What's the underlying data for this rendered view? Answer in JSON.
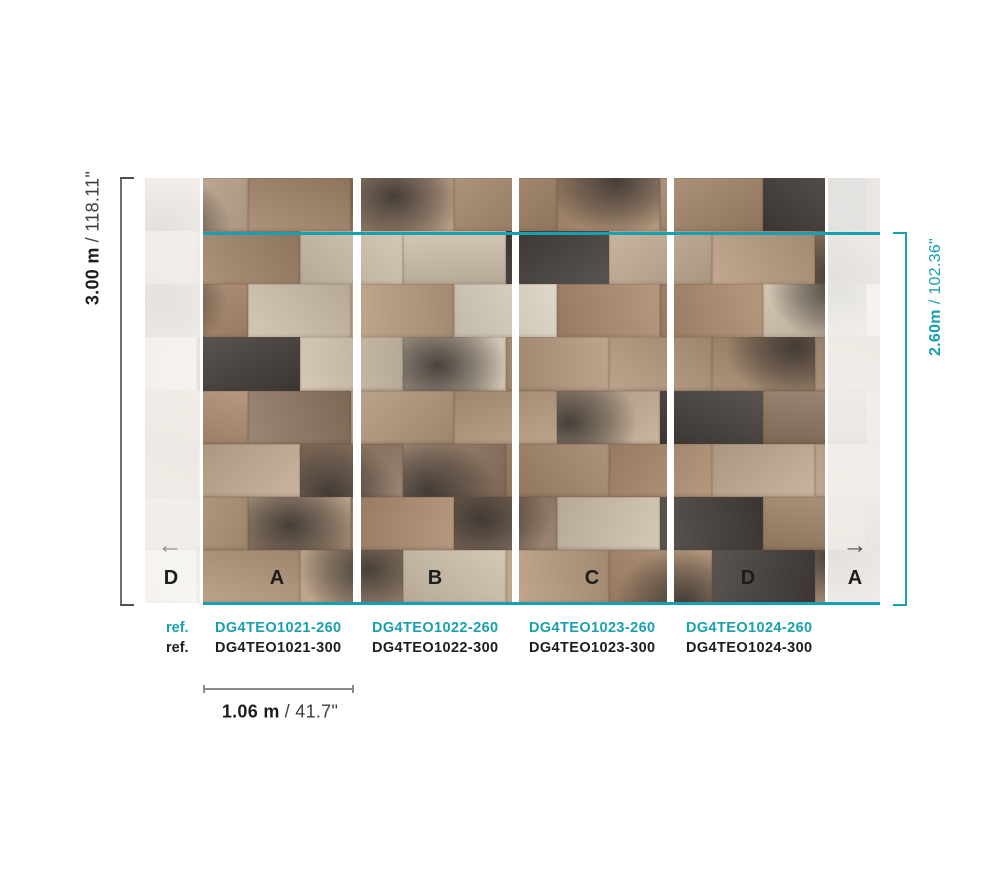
{
  "colors": {
    "teal": "#18a0b0",
    "text_black": "#1d1d1b",
    "bracket_gray": "#6f6f6f",
    "dim_secondary": "#3c3c3c"
  },
  "dimensions": {
    "full_height": {
      "metric": "3.00 m",
      "imperial": "/ 118.11\""
    },
    "panel_drop_height": {
      "metric": "2.60m",
      "imperial": "/ 102.36\""
    },
    "panel_width": {
      "metric": "1.06 m",
      "imperial": "/ 41.7\""
    }
  },
  "panels": [
    {
      "label": "D"
    },
    {
      "label": "A"
    },
    {
      "label": "B"
    },
    {
      "label": "C"
    },
    {
      "label": "D"
    },
    {
      "label": "A"
    }
  ],
  "icons": {
    "arrow_left": "←",
    "arrow_right": "→"
  },
  "references": {
    "rows": [
      {
        "label": "ref.",
        "codes": [
          "DG4TEO1021-260",
          "DG4TEO1022-260",
          "DG4TEO1023-260",
          "DG4TEO1024-260"
        ]
      },
      {
        "label": "ref.",
        "codes": [
          "DG4TEO1021-300",
          "DG4TEO1022-300",
          "DG4TEO1023-300",
          "DG4TEO1024-300"
        ]
      }
    ]
  },
  "mural": {
    "palette": [
      "#b4977c",
      "#ab8a6d",
      "#c2ab92",
      "#8f7560",
      "#cfc0ab",
      "#dcd2c2",
      "#b99c80",
      "#a18468"
    ],
    "dark_tile": "#433d39",
    "smudge": "56,51,47",
    "rows": 8,
    "tile_width": 103
  }
}
